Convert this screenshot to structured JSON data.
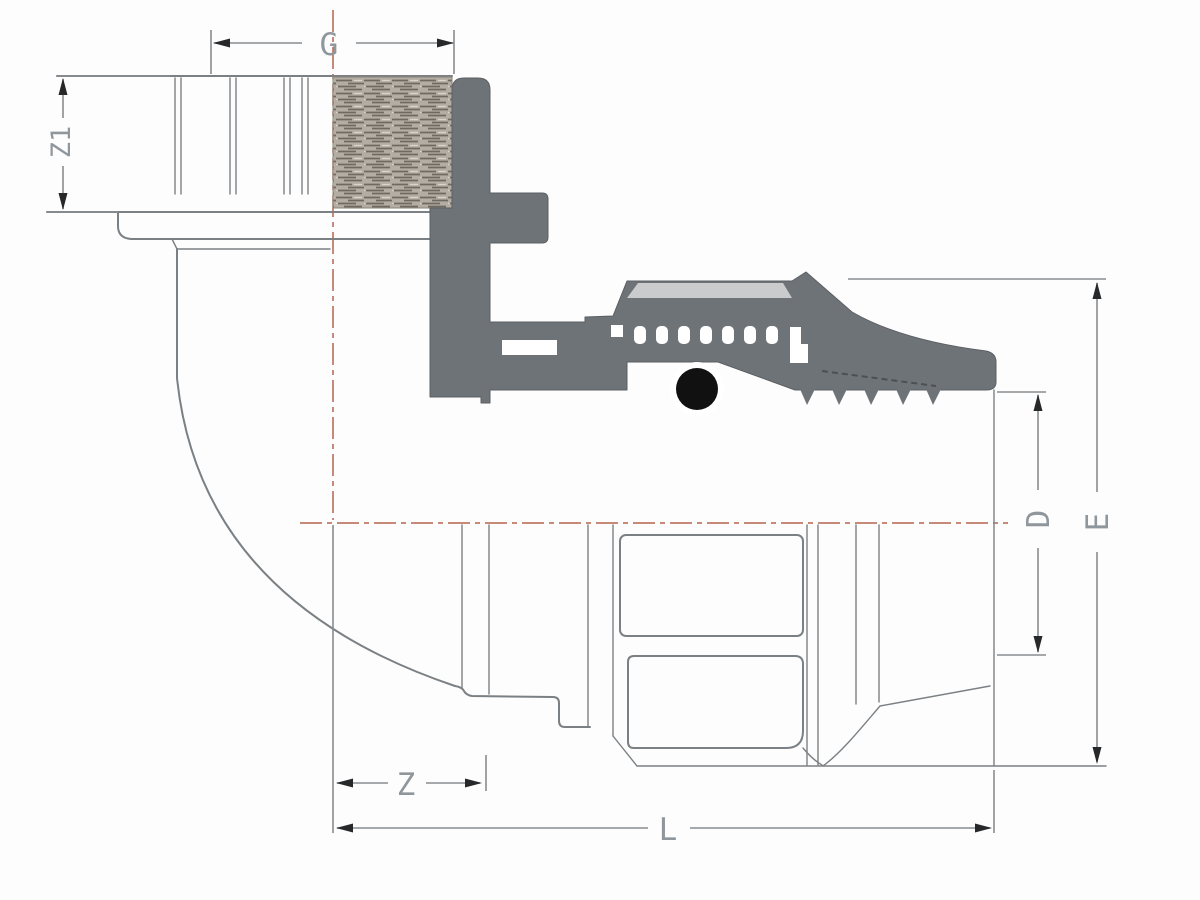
{
  "drawing": {
    "kind": "technical-dimension-drawing",
    "subject": "90-degree elbow compression fitting, half-section view",
    "dimension_labels": {
      "g": "G",
      "z1": "Z1",
      "z": "Z",
      "l": "L",
      "d": "D",
      "e": "E"
    },
    "colors": {
      "background": "#fdfdfd",
      "body_fill": "#6e7378",
      "body_edge": "#5b5f64",
      "nut_band_fill": "#c9cbcd",
      "oring_fill": "#111111",
      "outline": "#7b8084",
      "dimension_line": "#898d91",
      "arrowhead": "#26282a",
      "label_text": "#8f969c",
      "centerline": "#b5644d",
      "thread_hatch_bg": "#b4ada4",
      "thread_hatch_streak": "#6f6a61"
    }
  }
}
